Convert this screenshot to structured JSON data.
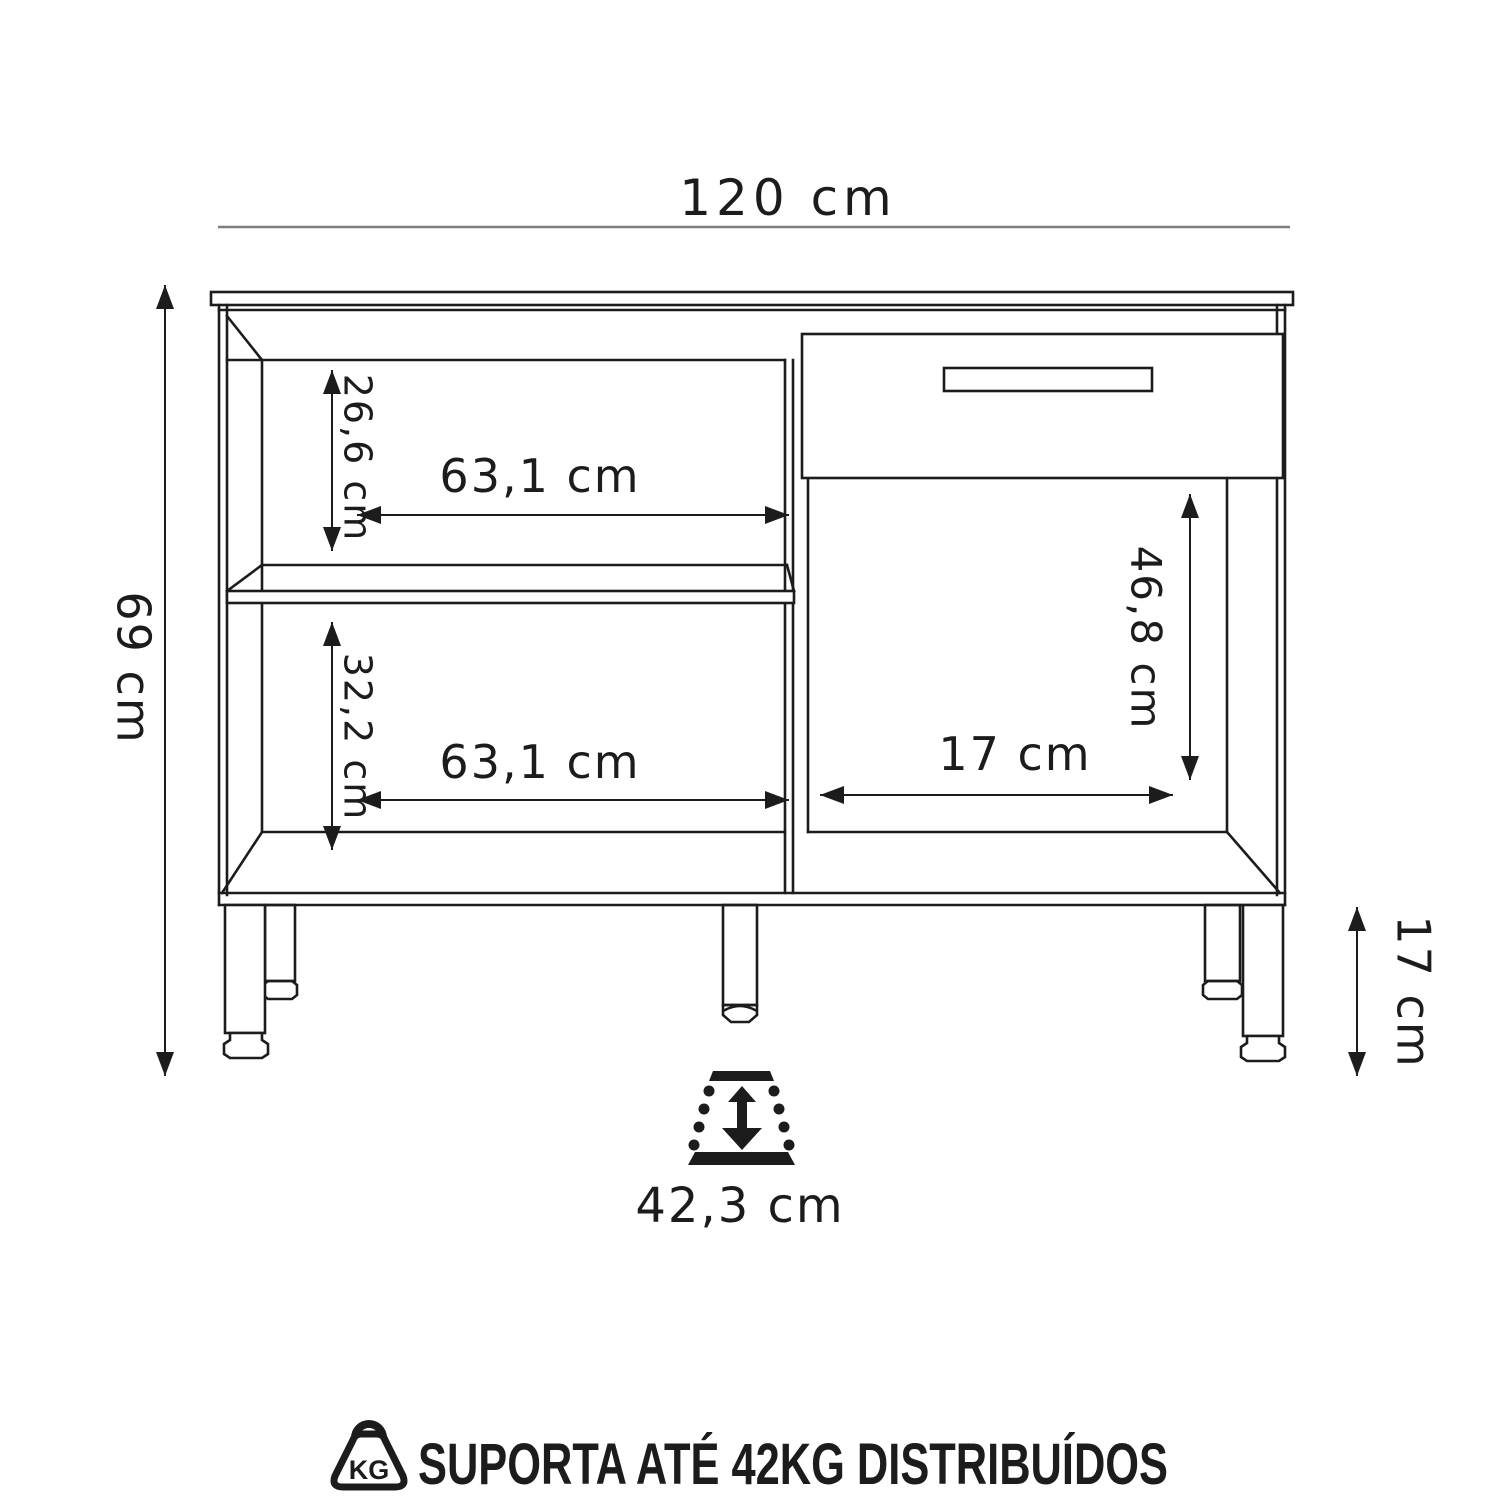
{
  "labels": {
    "width_total": "120 cm",
    "height_total": "69 cm",
    "upper_compartment_height": "26,6 cm",
    "upper_compartment_width": "63,1 cm",
    "lower_compartment_height": "32,2 cm",
    "lower_compartment_width": "63,1 cm",
    "right_compartment_height": "46,8 cm",
    "right_compartment_width": "17 cm",
    "leg_height": "17 cm",
    "depth": "42,3 cm",
    "kg_icon_text": "KG",
    "support_note": "SUPORTA ATÉ 42KG DISTRIBUÍDOS"
  },
  "colors": {
    "line": "#1c1c1c",
    "dim_gray": "#7e7e7e",
    "background": "#ffffff"
  }
}
